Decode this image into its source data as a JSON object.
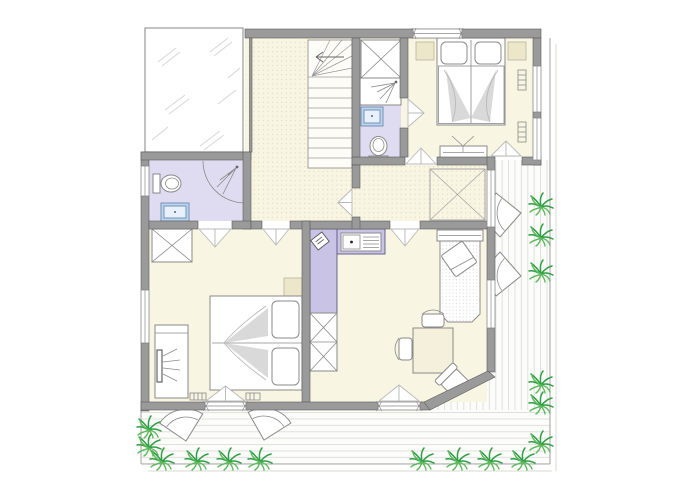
{
  "palette": {
    "canvas": "#ffffff",
    "wall": "#9a9a9a",
    "wall_stroke": "#5c5c5c",
    "room_cream": "#f8f5e2",
    "hall_dot": "#d8d1b2",
    "bath_lavender": "#dfdbf0",
    "counter_lavender": "#c9c4e6",
    "sink_blue": "#bcd4f0",
    "sink_blue_light": "#e8f1fb",
    "plant_green_dark": "#2f9e44",
    "plant_green_light": "#5cb85c",
    "furniture_stroke": "#8a8a8a",
    "shade_gray": "#d2d2d2",
    "nightstand_beige": "#ece7c9",
    "terrace_line": "#e0e0da",
    "terrace_border": "#aaaaaa",
    "stair_fill": "#fdfcf7",
    "glass_white": "#ffffff"
  },
  "plan": {
    "type": "residential floor plan, upper storey",
    "rooms": [
      {
        "name": "skylight-void",
        "features": [
          "glass hatching"
        ]
      },
      {
        "name": "hallway-landing",
        "features": [
          "staircase with winder",
          "up-arrow"
        ]
      },
      {
        "name": "bedroom-top-right",
        "furniture": [
          "double-bed",
          "nightstand-left",
          "nightstand-right",
          "wardrobe",
          "tv-dresser",
          "radiator",
          "radiator"
        ]
      },
      {
        "name": "ensuite-shower-room",
        "furniture": [
          "shower-tray",
          "washbasin",
          "toilet"
        ]
      },
      {
        "name": "bathroom-left",
        "furniture": [
          "toilet",
          "washbasin",
          "shower-head",
          "door-swing"
        ]
      },
      {
        "name": "bedroom-bottom-left",
        "furniture": [
          "double-bed",
          "wardrobe",
          "nightstand",
          "tv-dresser",
          "radiator",
          "radiator"
        ]
      },
      {
        "name": "kitchen-living-room",
        "furniture": [
          "l-shaped-kitchen-counter",
          "kitchen-sink",
          "small-appliance",
          "shelf-unit",
          "daybed-with-cushion",
          "side-shelf",
          "dining-table",
          "chair",
          "chair",
          "corner-chair"
        ]
      },
      {
        "name": "corridor",
        "furniture": [
          "built-in-closet-void"
        ]
      }
    ],
    "outdoor": {
      "terraces": [
        "right-terrace-vertical-decking",
        "bottom-terrace-horizontal-decking"
      ],
      "fan_chairs": 4,
      "plants": 16
    },
    "icons": {
      "plant": "grass tuft",
      "fan-chair": "quarter-fan patio chair",
      "shower": "corner dot with spray lines",
      "tv": "slim screen with viewing rays",
      "wardrobe": "rectangle with X diagonals"
    }
  }
}
